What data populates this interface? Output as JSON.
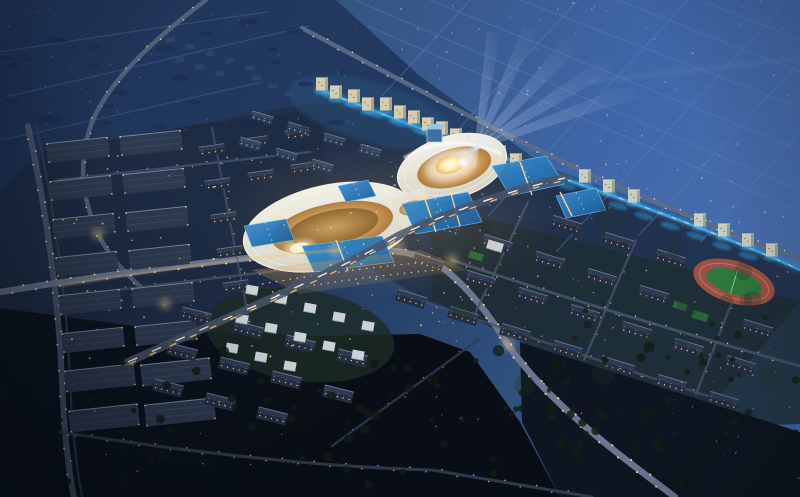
{
  "palette": {
    "night_sky": "#203459",
    "plain_blue": "#3f64a5",
    "plain_light": "#4a6fae",
    "grid_line": "#5a7fc0",
    "ground_dark": "#0b1119",
    "city_ground": "#202f48",
    "residential_green": "#1e2d33",
    "warehouse_ground": "#1d2a42",
    "road_main": "#6a7690",
    "road_dim": "#46536b",
    "streetlight_warm": "#ffe2a0",
    "window_warm": "#ffc87e",
    "building_dark": "#242e42",
    "roof_ridge": "#8a9cb5",
    "warehouse_roof": "#2e3a50",
    "ribbon_white": "#eceadf",
    "terrace_gold": "#d3a563",
    "courtyard_glow": "#fff6d0",
    "pool_blue": "#2374bc",
    "canal_blue": "#3aa8e8",
    "beam_white": "#dce8ff",
    "field_green": "#2e7a3e",
    "track_clay": "#9c5242",
    "tree_dark": "#131d17",
    "tower_cream": "#d6cdb0"
  },
  "terrain": {
    "polys": [
      {
        "name": "distant-plain",
        "pts": "336,0 800,0 800,268 680,214 545,166 420,76",
        "fill": "url(#gPlain)",
        "op": 1
      },
      {
        "name": "city-ground",
        "pts": "30,160 230,118 340,98 430,128 560,180 690,226 800,270 800,302 690,430 560,352 480,322 430,302 340,252 200,302 60,332 0,312 0,192",
        "fill": "#202f48",
        "op": 0.9
      },
      {
        "name": "warehouse-ground",
        "pts": "40,152 200,124 320,110 330,248 240,330 60,350",
        "fill": "#1d2a42",
        "op": 0.85
      },
      {
        "name": "residential-ground",
        "pts": "430,206 560,236 700,272 800,302 800,424 690,428 560,360 480,322 432,300",
        "fill": "#1e2d33",
        "op": 0.8
      },
      {
        "name": "dark-ground-left",
        "pts": "0,308 150,328 310,336 420,334 470,352 520,422 560,497 0,497",
        "fill": "url(#gGround)",
        "op": 1
      },
      {
        "name": "dark-ground-right",
        "pts": "520,342 800,432 800,497 560,497 522,422",
        "fill": "#0e1520",
        "op": 1
      }
    ],
    "ellipses": [
      {
        "name": "villa-green",
        "cx": 300,
        "cy": 335,
        "rx": 95,
        "ry": 46,
        "rot": 8,
        "fill": "#1d2c26",
        "op": 0.8
      },
      {
        "name": "cluster-blue-glow",
        "cx": 370,
        "cy": 112,
        "rx": 85,
        "ry": 30,
        "rot": 16,
        "fill": "#2a5480",
        "op": 0.45,
        "blur": "b2"
      }
    ],
    "grid_lines": [
      [
        355,
        0,
        800,
        190
      ],
      [
        430,
        0,
        800,
        150
      ],
      [
        520,
        0,
        800,
        108
      ],
      [
        618,
        0,
        800,
        72
      ],
      [
        700,
        0,
        800,
        40
      ],
      [
        368,
        26,
        800,
        212
      ],
      [
        470,
        0,
        382,
        96
      ],
      [
        578,
        0,
        430,
        160
      ],
      [
        688,
        0,
        488,
        216
      ],
      [
        788,
        0,
        556,
        252
      ],
      [
        800,
        62,
        638,
        236
      ],
      [
        800,
        132,
        700,
        242
      ]
    ],
    "horizon_band": {
      "x1": 588,
      "y1": 82,
      "x2": 800,
      "y2": 58
    },
    "far_curves": [
      "M 0,52 C 90,38 180,24 268,12",
      "M 0,98 C 100,76 210,48 310,26",
      "M 0,140 C 90,122 180,100 262,82"
    ]
  },
  "roads": [
    {
      "name": "left-rail",
      "d": "M 28,126 C 44,200 58,290 62,380 C 64,432 68,468 74,497",
      "w": 6,
      "c": "#4e5a72",
      "op": 0.9,
      "lights": {
        "sp": 13,
        "r": 0.9,
        "c": "#e8d9a8",
        "o": 2.6
      }
    },
    {
      "name": "left-rail-track",
      "d": "M 36,124 C 52,198 66,288 70,378 C 72,430 76,466 82,497",
      "w": 2,
      "c": "#3a4458",
      "op": 0.8
    },
    {
      "name": "left-curve-arterial",
      "d": "M 206,0 C 150,42 104,86 90,128 C 78,164 82,198 98,234 C 112,262 136,286 164,304",
      "w": 4.5,
      "c": "#5a6880",
      "op": 0.85,
      "lights": {
        "sp": 15,
        "r": 0.8,
        "c": "#dfd2a2",
        "o": 2
      }
    },
    {
      "name": "north-artery",
      "d": "M 302,28 C 400,80 500,134 590,174 C 680,212 745,240 800,258",
      "w": 4.5,
      "c": "#5d6d88",
      "op": 0.9,
      "lights": {
        "sp": 14,
        "r": 0.8,
        "c": "#cfe0f0",
        "o": 2.2
      }
    },
    {
      "name": "main-avenue",
      "d": "M 0,292 C 110,274 230,258 335,250 C 395,246 426,254 448,272 C 472,292 490,316 506,342 C 545,400 615,452 675,497",
      "w": 6.5,
      "c": "#6a7690",
      "op": 1,
      "lights": {
        "sp": 12,
        "r": 1,
        "c": "#ffe2a0",
        "o": 3
      }
    },
    {
      "name": "residential-street-1",
      "d": "M 452,260 C 540,290 650,324 800,366",
      "w": 2.8,
      "c": "#49566e",
      "op": 0.85,
      "lights": {
        "sp": 16,
        "r": 0.7,
        "c": "#e8d4a0",
        "o": 2
      }
    },
    {
      "name": "residential-street-2",
      "d": "M 420,300 C 520,334 620,368 720,400",
      "w": 2.5,
      "c": "#434f66",
      "op": 0.8,
      "lights": {
        "sp": 18,
        "r": 0.6,
        "c": "#dcc79a",
        "o": 1.8
      }
    },
    {
      "name": "residential-cross-1",
      "d": "M 528,202 L 472,320",
      "w": 2.4,
      "c": "#46536b",
      "op": 0.8,
      "lights": {
        "sp": 17,
        "r": 0.6,
        "c": "#d8c9a2",
        "o": 1.8
      }
    },
    {
      "name": "residential-cross-2",
      "d": "M 636,240 L 584,360",
      "w": 2.4,
      "c": "#46536b",
      "op": 0.8,
      "lights": {
        "sp": 17,
        "r": 0.6,
        "c": "#d8c9a2",
        "o": 1.8
      }
    },
    {
      "name": "residential-cross-3",
      "d": "M 742,276 L 696,394",
      "w": 2.4,
      "c": "#46536b",
      "op": 0.8,
      "lights": {
        "sp": 17,
        "r": 0.6,
        "c": "#d8c9a2",
        "o": 1.8
      }
    },
    {
      "name": "warehouse-street-1",
      "d": "M 58,180 L 310,152",
      "w": 2.4,
      "c": "#46536b",
      "op": 0.8,
      "lights": {
        "sp": 15,
        "r": 0.6,
        "c": "#e0cf9e",
        "o": 1.8
      }
    },
    {
      "name": "warehouse-street-2",
      "d": "M 66,296 L 300,268",
      "w": 2.4,
      "c": "#46536b",
      "op": 0.8,
      "lights": {
        "sp": 15,
        "r": 0.6,
        "c": "#e0cf9e",
        "o": 1.8
      }
    },
    {
      "name": "warehouse-street-3",
      "d": "M 212,128 L 252,336",
      "w": 2.2,
      "c": "#414e64",
      "op": 0.8,
      "lights": {
        "sp": 18,
        "r": 0.6,
        "c": "#e0cf9e",
        "o": 1.8
      }
    },
    {
      "name": "south-street",
      "d": "M 60,432 C 240,460 360,468 432,470 L 592,497",
      "w": 3,
      "c": "#323e52",
      "op": 0.9,
      "lights": {
        "sp": 16,
        "r": 0.7,
        "c": "#d8c08a",
        "o": 2
      }
    },
    {
      "name": "south-diagonal",
      "d": "M 478,340 L 332,446",
      "w": 2.4,
      "c": "#2e3a4e",
      "op": 0.85,
      "lights": {
        "sp": 22,
        "r": 0.55,
        "c": "#c8b48a",
        "o": 1.6
      }
    }
  ],
  "expressway": {
    "name": "elevated-expressway",
    "d": "M 128,362 C 240,312 330,275 400,235 C 450,212 510,190 565,178",
    "base_c": "#4a5568",
    "base_w": 8,
    "trail_white": {
      "dash": "10 16",
      "c": "#ffffff",
      "w": 1.3
    },
    "trail_amber": {
      "dash": "7 15",
      "c": "#ffbb66",
      "w": 1.4,
      "shift": [
        1.5,
        2
      ]
    },
    "avenue_glow": {
      "d": "M 60,286 C 180,266 280,254 340,250",
      "c": "#f2c27c",
      "w": 2,
      "op": 0.5
    }
  },
  "canal": {
    "d": "M 316,88 C 400,122 480,150 556,176 C 650,208 735,240 800,270",
    "main_c": "#3aa8e8",
    "glow_c": "#57b8f0",
    "dash_c": "#aee2ff",
    "patches": [
      [
        330,
        96
      ],
      [
        352,
        105
      ],
      [
        374,
        114
      ],
      [
        398,
        123
      ],
      [
        422,
        132
      ],
      [
        446,
        141
      ],
      [
        470,
        150
      ],
      [
        494,
        159
      ],
      [
        518,
        168
      ],
      [
        542,
        177
      ],
      [
        566,
        186
      ],
      [
        592,
        196
      ],
      [
        618,
        206
      ],
      [
        644,
        216
      ],
      [
        670,
        226
      ],
      [
        696,
        236
      ],
      [
        722,
        246
      ],
      [
        748,
        256
      ]
    ]
  },
  "building_grids": [
    {
      "name": "warehouse-block",
      "style": "warehouse",
      "origin": [
        78,
        150
      ],
      "col": [
        73,
        -7
      ],
      "cols": 2,
      "row": [
        3,
        38
      ],
      "rows": 6,
      "size": [
        62,
        20
      ],
      "rot": -6,
      "skip": []
    },
    {
      "name": "warehouse-slab",
      "style": "warehouse",
      "origin": [
        100,
        378
      ],
      "col": [
        76,
        -6
      ],
      "cols": 2,
      "row": [
        4,
        40
      ],
      "rows": 2,
      "size": [
        70,
        22
      ],
      "rot": -6,
      "skip": []
    },
    {
      "name": "midrise-west",
      "style": "apartment",
      "origin": [
        212,
        150
      ],
      "col": [
        43,
        -8
      ],
      "cols": 3,
      "row": [
        6,
        34
      ],
      "rows": 5,
      "size": [
        26,
        10
      ],
      "rot": -8,
      "skip": [
        "2,1",
        "2,2",
        "3,1",
        "3,2",
        "4,1",
        "4,2"
      ]
    },
    {
      "name": "north-cluster-block",
      "style": "apartment_dim",
      "origin": [
        262,
        118
      ],
      "col": [
        36,
        11
      ],
      "cols": 5,
      "row": [
        -12,
        26
      ],
      "rows": 2,
      "size": [
        22,
        9
      ],
      "rot": 16,
      "skip": [
        "0,4",
        "1,3",
        "1,4"
      ]
    },
    {
      "name": "apartment-right",
      "style": "apartment",
      "origin": [
        462,
        191
      ],
      "col": [
        52,
        17
      ],
      "cols": 7,
      "row": [
        -17,
        36
      ],
      "rows": 4,
      "size": [
        30,
        12
      ],
      "rot": 17,
      "skip": [
        "0,0",
        "0,1",
        "0,5",
        "0,6",
        "1,5"
      ]
    },
    {
      "name": "apartment-south",
      "style": "apartment",
      "origin": [
        196,
        316
      ],
      "col": [
        52,
        14
      ],
      "cols": 5,
      "row": [
        -14,
        36
      ],
      "rows": 3,
      "size": [
        30,
        12
      ],
      "rot": 14,
      "skip": [
        "0,4",
        "1,4",
        "2,3",
        "2,4"
      ]
    },
    {
      "name": "villa",
      "style": "villa",
      "origin": [
        252,
        290
      ],
      "col": [
        29,
        9
      ],
      "cols": 5,
      "row": [
        -10,
        29
      ],
      "rows": 3,
      "size": [
        12,
        9
      ],
      "rot": 10,
      "skip": [
        "2,3",
        "2,4"
      ]
    }
  ],
  "towers": [
    [
      322,
      84
    ],
    [
      336,
      92
    ],
    [
      354,
      96
    ],
    [
      368,
      104
    ],
    [
      386,
      104
    ],
    [
      400,
      112
    ],
    [
      414,
      117
    ],
    [
      428,
      124
    ],
    [
      442,
      128
    ],
    [
      456,
      135
    ],
    [
      484,
      144
    ],
    [
      500,
      152
    ],
    [
      516,
      160
    ],
    [
      585,
      176
    ],
    [
      609,
      186
    ],
    [
      634,
      196
    ],
    [
      700,
      220
    ],
    [
      724,
      230
    ],
    [
      748,
      240
    ],
    [
      772,
      250
    ]
  ],
  "far_blocks": [
    [
      165,
      38
    ],
    [
      185,
      45
    ],
    [
      205,
      52
    ],
    [
      225,
      59
    ],
    [
      245,
      66
    ],
    [
      175,
      58
    ],
    [
      195,
      65
    ],
    [
      215,
      72
    ],
    [
      252,
      76
    ],
    [
      268,
      84
    ],
    [
      284,
      92
    ]
  ],
  "clubhouse": {
    "x": 495,
    "y": 246,
    "w": 16,
    "h": 9,
    "rot": 17
  },
  "courts": [
    [
      700,
      316,
      16,
      8
    ],
    [
      680,
      306,
      14,
      7
    ],
    [
      476,
      256,
      14,
      7
    ]
  ],
  "complex": {
    "haze": {
      "cx": 385,
      "cy": 218,
      "rx": 175,
      "ry": 80
    },
    "left_lobe": {
      "cx": 330,
      "cy": 227,
      "rot": -12,
      "ribbon": [
        88,
        42
      ],
      "rings": [
        [
          80,
          37
        ],
        [
          72,
          32
        ]
      ],
      "gold": [
        62,
        24
      ],
      "gold_inner": [
        46,
        17
      ],
      "spot": {
        "cx": 296,
        "cy": 241,
        "rx": 10,
        "ry": 5
      }
    },
    "right_lobe": {
      "cx": 452,
      "cy": 167,
      "rot": -16,
      "ribbon": [
        56,
        31
      ],
      "rings": [
        [
          49,
          26
        ],
        [
          42,
          21
        ]
      ],
      "gold": [
        38,
        19
      ],
      "court": {
        "cx": 451,
        "cy": 164,
        "rx": 15,
        "ry": 9
      },
      "rim": "M 404,158 Q 450,130 502,154"
    },
    "waist": {
      "pts": "392,200 424,186 434,212 402,228",
      "gold": {
        "cx": 412,
        "cy": 208,
        "rx": 13,
        "ry": 7,
        "rot": -14
      }
    },
    "cube": {
      "x": 427,
      "y": 129,
      "w": 15,
      "h": 13
    }
  },
  "pools": [
    {
      "name": "pool-north",
      "pts": "338,186 368,180 376,196 346,202"
    },
    {
      "name": "pool-east-1",
      "pts": "402,204 468,192 482,222 416,234"
    },
    {
      "name": "pool-east-2",
      "pts": "492,166 546,156 564,184 510,196"
    },
    {
      "name": "pool-west-1",
      "pts": "302,246 382,236 394,262 314,272"
    },
    {
      "name": "pool-west-2",
      "pts": "244,226 286,219 294,240 252,247"
    },
    {
      "name": "pool-far-east",
      "pts": "556,196 596,188 606,210 566,218"
    }
  ],
  "bridges": [
    [
      424,
      196,
      436,
      232
    ],
    [
      450,
      190,
      460,
      226
    ],
    [
      336,
      240,
      348,
      271
    ],
    [
      520,
      162,
      532,
      195
    ],
    [
      560,
      192,
      572,
      216
    ]
  ],
  "plaza": {
    "pts": "252,270 420,250 468,270 300,294",
    "rows": [
      "M 262,284 C 320,274 380,266 428,262",
      "M 272,292 C 330,282 390,274 438,270"
    ]
  },
  "sports_field": {
    "cx": 734,
    "cy": 282,
    "rot": 17,
    "track": [
      42,
      21
    ],
    "lane": [
      36,
      16
    ],
    "green": [
      29,
      12
    ]
  },
  "beams": {
    "source": [
      463,
      162
    ],
    "list": [
      {
        "s": [
          474,
          168
        ],
        "t": [
          494,
          32
        ],
        "w": 7
      },
      {
        "s": [
          468,
          166
        ],
        "t": [
          531,
          28
        ],
        "w": 8
      },
      {
        "s": [
          462,
          163
        ],
        "t": [
          573,
          42
        ],
        "w": 9
      },
      {
        "s": [
          456,
          160
        ],
        "t": [
          609,
          64
        ],
        "w": 9
      },
      {
        "s": [
          450,
          157
        ],
        "t": [
          635,
          90
        ],
        "w": 8
      }
    ]
  },
  "glow_spots": [
    [
      398,
      246
    ],
    [
      452,
      260
    ],
    [
      335,
      250
    ],
    [
      98,
      234
    ],
    [
      508,
      344
    ],
    [
      165,
      304
    ]
  ],
  "scatter": [
    {
      "r": [
        390,
        0,
        410,
        245
      ],
      "n": 85,
      "c": "#b8cfe8",
      "s": [
        0.5,
        1.1
      ],
      "o": 0.5,
      "seed": 7
    },
    {
      "r": [
        0,
        0,
        360,
        130
      ],
      "n": 48,
      "c": "#93abc9",
      "s": [
        0.4,
        0.9
      ],
      "o": 0.4,
      "seed": 11
    },
    {
      "r": [
        0,
        15,
        340,
        115
      ],
      "n": 26,
      "c": "#17284e",
      "s": [
        5,
        11
      ],
      "o": 0.5,
      "seed": 81,
      "squash": true
    },
    {
      "r": [
        60,
        140,
        370,
        220
      ],
      "n": 65,
      "c": "#ffd98f",
      "s": [
        0.5,
        1.1
      ],
      "o": 0.7,
      "seed": 21
    },
    {
      "r": [
        430,
        205,
        360,
        180
      ],
      "n": 55,
      "c": "#f5cd8e",
      "s": [
        0.4,
        1
      ],
      "o": 0.6,
      "seed": 31
    },
    {
      "r": [
        440,
        215,
        350,
        170
      ],
      "n": 20,
      "c": "#22352a",
      "s": [
        6,
        12
      ],
      "o": 0.3,
      "seed": 61
    },
    {
      "r": [
        0,
        345,
        690,
        140
      ],
      "n": 58,
      "c": "#121c15",
      "s": [
        2.5,
        5
      ],
      "o": 0.85,
      "seed": 41
    },
    {
      "r": [
        520,
        300,
        280,
        150
      ],
      "n": 26,
      "c": "#141f19",
      "s": [
        2,
        4.5
      ],
      "o": 0.8,
      "seed": 51
    },
    {
      "r": [
        340,
        340,
        320,
        120
      ],
      "n": 18,
      "c": "#10190f",
      "s": [
        3,
        6
      ],
      "o": 0.7,
      "seed": 101
    },
    {
      "r": [
        70,
        395,
        550,
        85
      ],
      "n": 20,
      "c": "#e3c184",
      "s": [
        0.5,
        0.9
      ],
      "o": 0.6,
      "seed": 71
    },
    {
      "r": [
        660,
        380,
        140,
        100
      ],
      "n": 14,
      "c": "#cdb98e",
      "s": [
        0.4,
        0.8
      ],
      "o": 0.55,
      "seed": 91
    }
  ]
}
